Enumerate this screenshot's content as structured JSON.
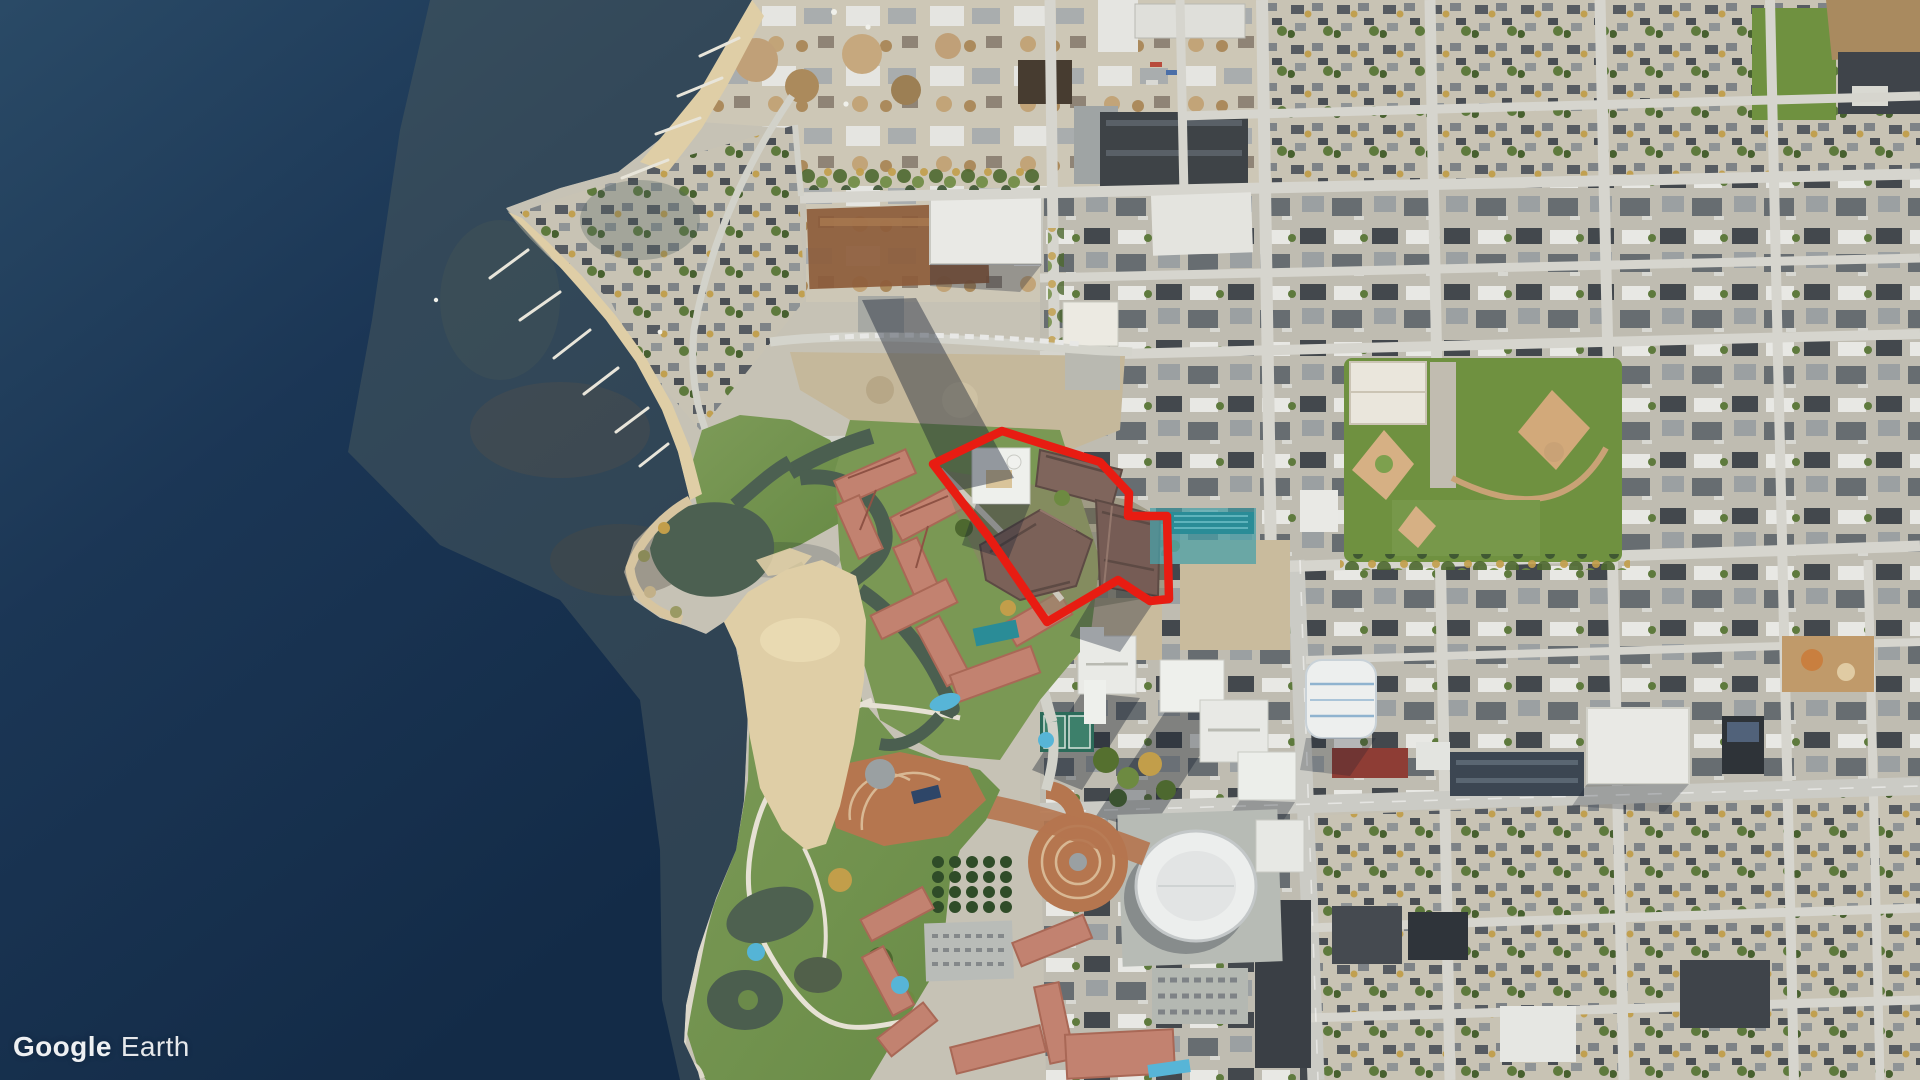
{
  "watermark": {
    "brand": "Google",
    "product": "Earth"
  },
  "map": {
    "view": "satellite-aerial",
    "highlight_outline": {
      "points": "933,464 1002,431 1100,462 1129,493 1128,516 1167,516 1169,599 1150,601 1136,592 1118,580 1047,622 988,536",
      "color": "#e81c12",
      "stroke_width": 8.5
    },
    "palette": {
      "deep_water": "#16304e",
      "shallow_water": "#47585c",
      "sand": "#dfcea6",
      "grass": "#76954e",
      "urban": "#c6c2b5",
      "resort_roof": "#c28270",
      "site_roof": "#7a6057",
      "street": "#d6d5ce"
    }
  }
}
